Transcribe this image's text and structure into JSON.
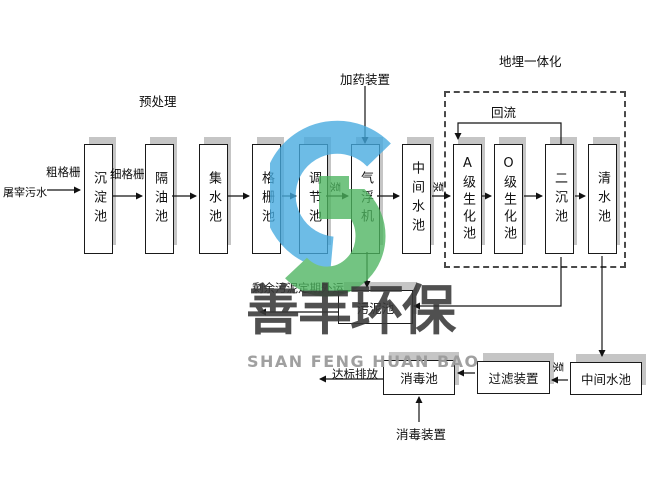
{
  "diagram": {
    "influent_label": "屠宰污水",
    "coarse_screen_label": "粗格栅",
    "fine_screen_label": "细格栅",
    "pretreatment_label": "预处理",
    "dosing_device_label": "加药装置",
    "buried_integration_label": "地埋一体化",
    "reflux_label": "回流",
    "pump_label": "泵",
    "excess_sludge_label": "剩余污泥定期外运",
    "discharge_label": "达标排放",
    "disinfection_device_label": "消毒装置"
  },
  "tanks": [
    {
      "label": "沉淀池"
    },
    {
      "label": "隔油池"
    },
    {
      "label": "集水池"
    },
    {
      "label": "格栅池"
    },
    {
      "label": "调节池"
    },
    {
      "label": "气浮机"
    },
    {
      "label": "中间水池"
    },
    {
      "label": "A级生化池"
    },
    {
      "label": "O级生化池"
    },
    {
      "label": "二沉池"
    },
    {
      "label": "清水池"
    }
  ],
  "bottom_tanks": [
    {
      "label": "污泥池"
    },
    {
      "label": "消毒池"
    },
    {
      "label": "过滤装置"
    },
    {
      "label": "中间水池"
    }
  ],
  "watermark": {
    "cn": "善丰环保",
    "en": "SHAN FENG HUAN BAO",
    "blue": "#45aadf",
    "green": "#4db45f"
  }
}
